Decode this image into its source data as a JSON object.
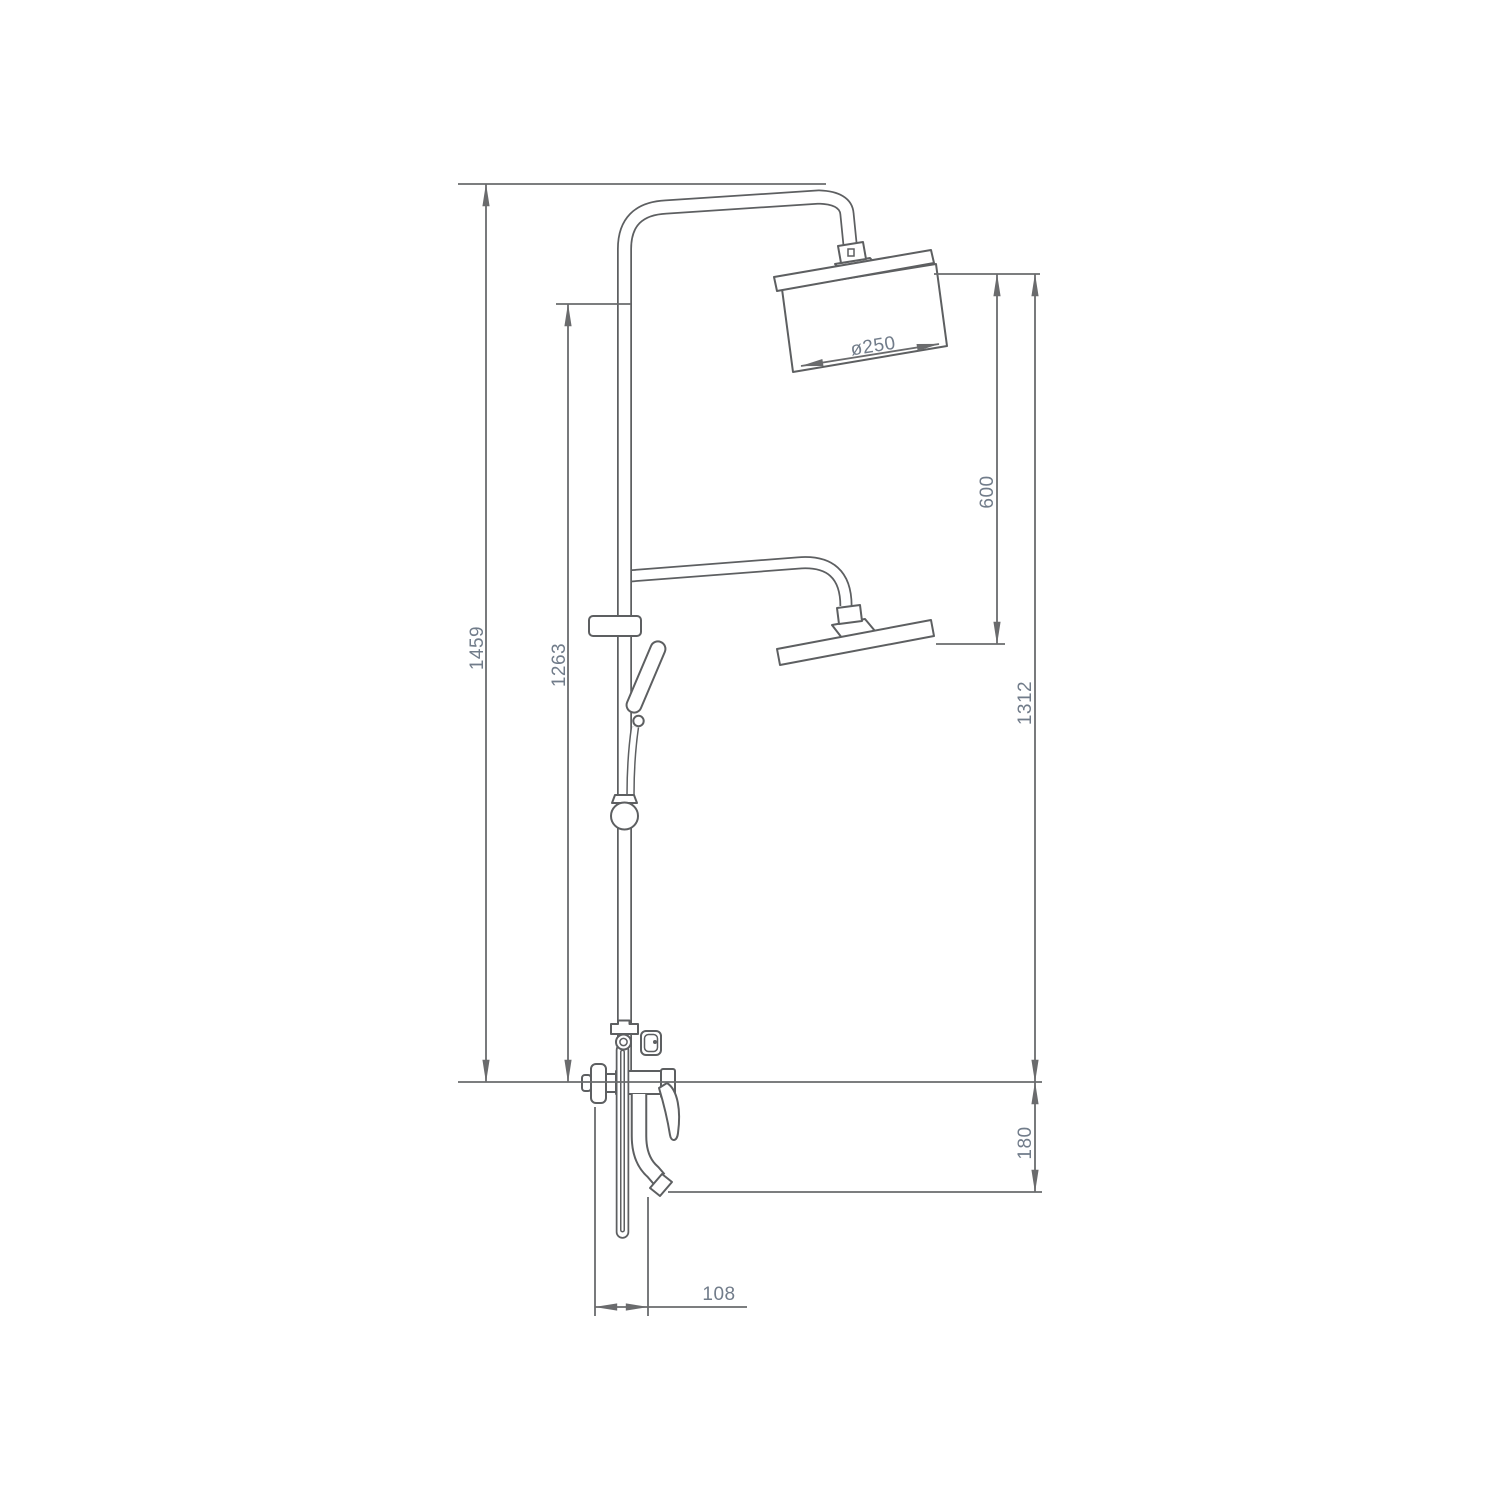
{
  "diagram": {
    "dimensions": {
      "total_height": "1459",
      "riser_height": "1263",
      "head_diameter": "ø250",
      "head_to_head": "600",
      "arm_height": "1312",
      "spout_drop": "180",
      "spout_offset": "108"
    },
    "colors": {
      "outline": "#5d5f61",
      "dimension_line": "#6a6b6d",
      "dimension_text": "#717c8a",
      "background": "#ffffff"
    }
  }
}
